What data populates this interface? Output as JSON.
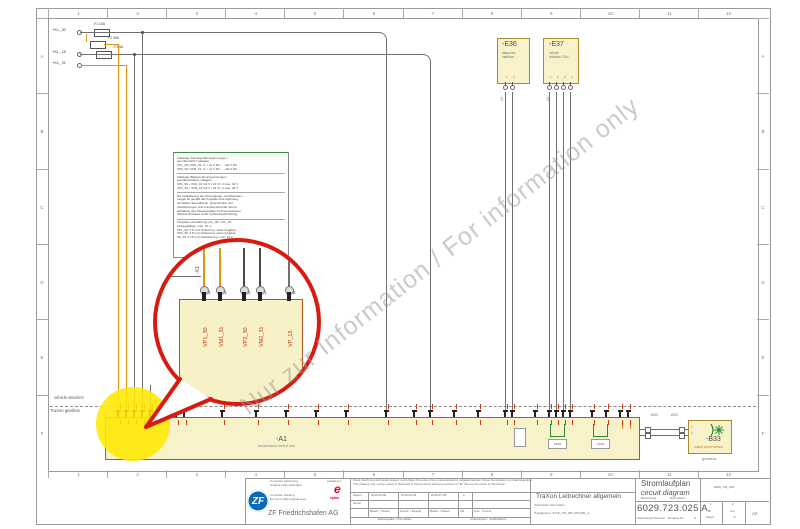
{
  "frame": {
    "cols": [
      "1",
      "2",
      "3",
      "4",
      "5",
      "6",
      "7",
      "8",
      "9",
      "10",
      "11",
      "12"
    ],
    "rows": [
      "A",
      "B",
      "C",
      "D",
      "E",
      "F"
    ]
  },
  "watermark": {
    "text": "Nur zur Information / For information only"
  },
  "zones": {
    "vehicle": "vehicle electrics",
    "traxon": "TraXon gearbox",
    "gearbox": "gearbox"
  },
  "power": {
    "terminals": [
      {
        "label": "+KL_30"
      },
      {
        "label": "+KL_15"
      },
      {
        "label": "+KL_31"
      }
    ],
    "fuses": [
      {
        "label": "-F1 10A"
      },
      {
        "label": "-F2 30A"
      },
      {
        "label": "-F3 5A"
      }
    ]
  },
  "note_box": {
    "sections": [
      {
        "lines": [
          "Zulässige Steuergeräte-Spannungen /",
          "permitted ECU voltages:",
          "VP1_30 / VM1_31:   U = +9 V DC ... +32 V DC",
          "VP2_30 / VM2_31:   U = +9 V DC ... +32 V DC"
        ]
      },
      {
        "lines": [
          "Zulässige Batterie-Nennspannungen /",
          "permitted battery voltages:",
          "VP1_30 + VM1_31 (12 V / 24 V):  U max. 32 V",
          "VP2_30 + VM2_31 (12 V / 24 V):  U max. 32 V"
        ]
      },
      {
        "lines": [
          "Die Verkabelung der Versorgungs- und Masselei-",
          "tungen ist gemäß den Angaben des Fahrzeug-",
          "herstellers auszuführen. Querschnitte und",
          "Absicherungen sind entsprechend der Strom-",
          "aufnahme des Steuergerätes zu dimensionieren.",
          "Weitere Hinweise siehe Systembeschreibung."
        ]
      },
      {
        "lines": [
          "Vorgaben Verdrahtung +KL_30 / +KL_15:",
          "Leitungslänge: max. 10 m",
          "VP1_30:  2.5 mm²   Sicherung: siehe Angaben",
          "VP2_30:  2.5 mm²   Sicherung: siehe Angaben",
          "VP_15:  0.75 mm²   Absicherung: max. 10 A"
        ]
      }
    ]
  },
  "magnifier": {
    "connector": "-X1",
    "pins": [
      {
        "no": "4",
        "signal": "VP1_30"
      },
      {
        "no": "3",
        "signal": "VM1_31"
      },
      {
        "no": "2",
        "signal": "VP2_30"
      },
      {
        "no": "1",
        "signal": "VM2_31"
      },
      {
        "no": "8",
        "signal": "VP_15"
      }
    ]
  },
  "components": {
    "e36": {
      "ref": "-E36",
      "desc": "diagnosis interface",
      "connector": "-X2"
    },
    "e37": {
      "ref": "-E37",
      "desc": "vehicle driveline CAN",
      "connector": "-X3"
    },
    "a1": {
      "ref": "-A1",
      "desc": "transmission control unit",
      "terminators": [
        "120Ω",
        "120Ω"
      ]
    },
    "b33": {
      "ref": "-B33",
      "desc": "output speed sensor"
    },
    "wires": {
      "w1": "-W43",
      "w2": "-W33"
    }
  },
  "titleblock": {
    "left": {
      "de1": "Computer Zeichnung",
      "de2": "Original nicht verändern.",
      "en1": "Computer drawing",
      "en2": "Do not modify original copy",
      "zf": "ZF",
      "company": "ZF Friedrichshafen AG"
    },
    "eplan": {
      "created": "erstellt mit",
      "logo": "e",
      "name": "eplan"
    },
    "disclaimer_de": "Diese Zeichnung darf weder kopiert, noch dritten Personen ohne unsere Erlaubnis mitgeteilt werden. Diese Konstruktion ist unser Eigentum.",
    "disclaimer_en": "This drawing may not be copied or disclosed to third persons without permission of ZF. We are the owner of this design.",
    "table": {
      "datum": "Datum",
      "name": "Name",
      "dates": [
        "2016-04-04",
        "2016-05-04",
        "2016-07-08"
      ],
      "rev": "a",
      "roles": [
        "Bearb. / Drawn",
        "Konstr. / Design",
        "Bearb. / Drawn"
      ],
      "ind": "Ind.",
      "aend": "Änd. / Grund",
      "first_edition": "Erstausgabe / first edition",
      "modifications": "Änderungen / modifications"
    },
    "info": {
      "tech": "Technische Information",
      "project": "Projektname: 6Y08_723_025_PDA001_A"
    },
    "desc": {
      "type_de": "Stromlaufplan",
      "type_en": "circuit diagram",
      "benennung": "Benennung",
      "description": "Description",
      "title": "TraXon Leitrechner allgemein"
    },
    "number": {
      "value": "6029.723.025 A",
      "label_de": "Zeichnungs-Nummer",
      "label_en": "Drawing-No.",
      "aend": "Ä",
      "file": "6029_723_025"
    },
    "sheet": {
      "no": "1",
      "bl": "Bl.",
      "sheet": "Sheet",
      "of_no": "2",
      "von": "von",
      "of": "of",
      "size": "A2"
    }
  },
  "colors": {
    "bubble_red": "#d81a10",
    "highlight_yellow": "#ffe800",
    "component_fill": "#f7f2c9",
    "component_border": "#a98b2d",
    "strip_border": "#b4561e",
    "wire_orange": "#e2930f",
    "signal_red": "#c33a12",
    "zf_blue": "#0a6ab5",
    "eplan_red": "#e2001a"
  }
}
